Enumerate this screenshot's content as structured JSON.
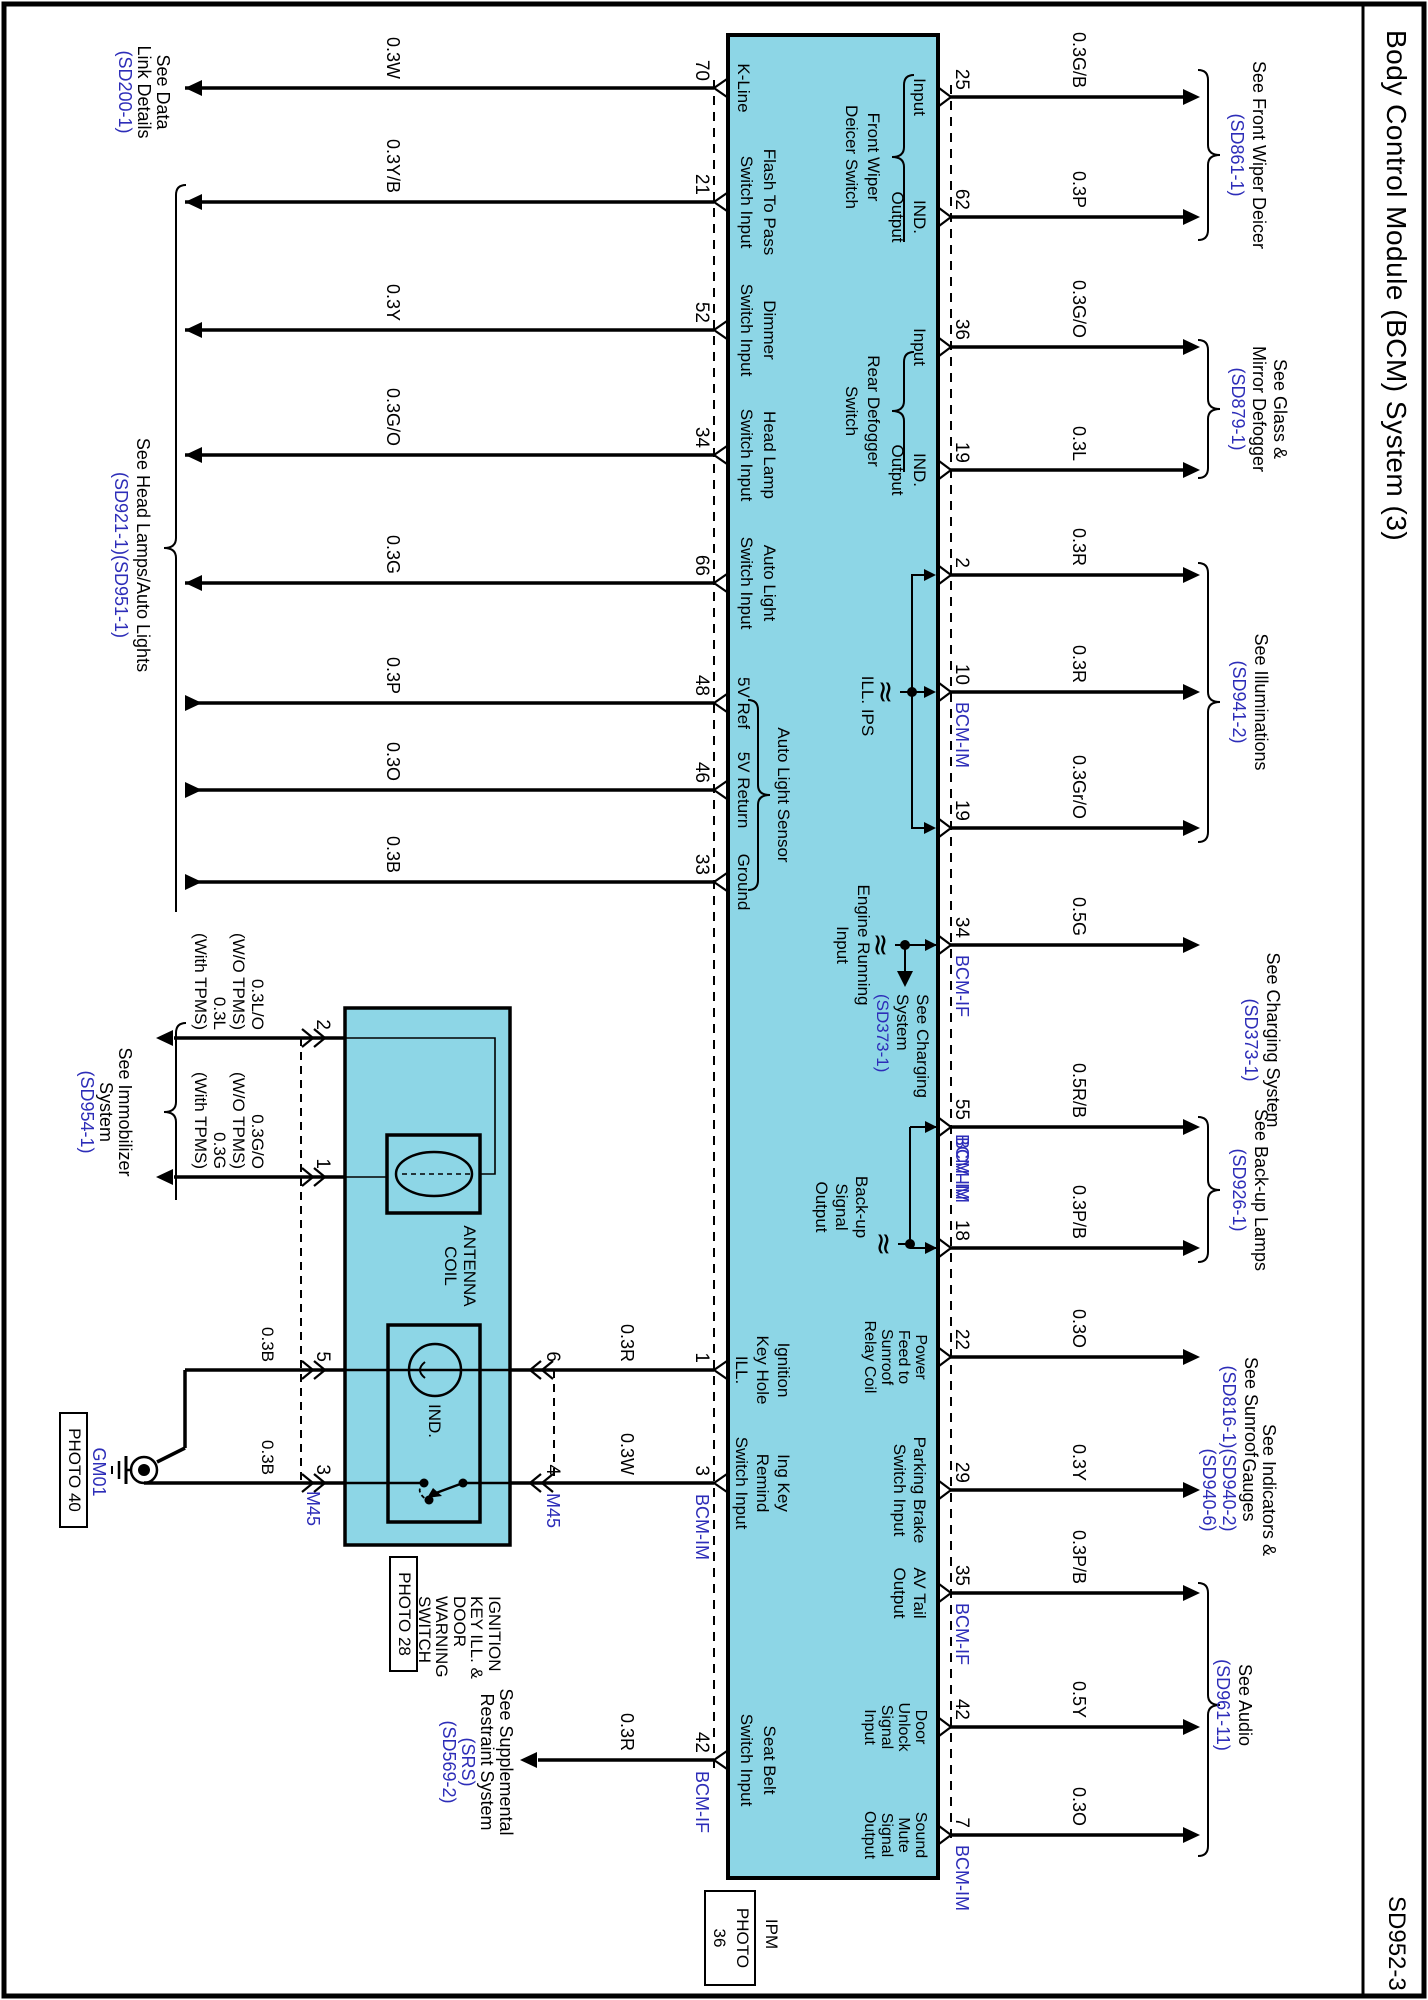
{
  "page": {
    "title": "Body Control Module (BCM) System (3)",
    "code": "SD952-3"
  },
  "colors": {
    "module_fill": "#8dd6e6",
    "reference_blue": "#2d2db8",
    "line": "#000000"
  },
  "top_pins": [
    {
      "num": "25",
      "x": 97,
      "wire": "0.3G/B",
      "inside": [
        "Input"
      ]
    },
    {
      "num": "62",
      "x": 217,
      "wire": "0.3P",
      "inside": [
        "IND.",
        "Output"
      ]
    },
    {
      "num": "36",
      "x": 347,
      "wire": "0.3G/O",
      "inside": [
        "Input"
      ]
    },
    {
      "num": "19",
      "x": 470,
      "wire": "0.3L",
      "inside": [
        "IND.",
        "Output"
      ]
    },
    {
      "num": "2",
      "x": 575,
      "wire": "0.3R",
      "inside": []
    },
    {
      "num": "10",
      "x": 692,
      "wire": "0.3R",
      "conn": "BCM-IM",
      "inside": []
    },
    {
      "num": "19",
      "x": 828,
      "wire": "0.3Gr/O",
      "inside": []
    },
    {
      "num": "34",
      "x": 945,
      "wire": "0.5G",
      "conn": "BCM-IF",
      "inside": []
    },
    {
      "num": "55",
      "x": 1127,
      "wire": "0.5R/B",
      "conn": "BCM-IM",
      "inside": []
    },
    {
      "num": "18",
      "x": 1248,
      "wire": "0.3P/B",
      "conn": "BCM-IM",
      "conn_pos": "before",
      "inside": []
    },
    {
      "num": "22",
      "x": 1357,
      "wire": "0.3O",
      "inside": [
        "Power",
        "Feed to",
        "Sunroof",
        "Relay Coil"
      ],
      "ilh": 17,
      "ifs": 16
    },
    {
      "num": "29",
      "x": 1490,
      "wire": "0.3Y",
      "inside": [
        "Parking Brake",
        "Switch Input"
      ],
      "ilh": 20
    },
    {
      "num": "35",
      "x": 1593,
      "wire": "0.3P/B",
      "conn": "BCM-IF",
      "inside": [
        "AV Tail",
        "Output"
      ],
      "ilh": 20
    },
    {
      "num": "42",
      "x": 1727,
      "wire": "0.5Y",
      "inside": [
        "Door",
        "Unlock",
        "Signal",
        "Input"
      ],
      "ilh": 17,
      "ifs": 16
    },
    {
      "num": "7",
      "x": 1835,
      "wire": "0.3O",
      "conn": "BCM-IM",
      "inside": [
        "Sound",
        "Mute",
        "Signal",
        "Output"
      ],
      "ilh": 17,
      "ifs": 16
    }
  ],
  "bottom_pins": [
    {
      "num": "70",
      "x": 88,
      "wire": "0.3W",
      "inside": [
        "K-Line"
      ],
      "dir": "out"
    },
    {
      "num": "21",
      "x": 202,
      "wire": "0.3Y/B",
      "inside": [
        "Flash To Pass",
        "Switch Input"
      ],
      "dir": "out"
    },
    {
      "num": "52",
      "x": 330,
      "wire": "0.3Y",
      "inside": [
        "Dimmer",
        "Switch Input"
      ],
      "dir": "out"
    },
    {
      "num": "34",
      "x": 455,
      "wire": "0.3G/O",
      "inside": [
        "Head Lamp",
        "Switch Input"
      ],
      "dir": "out"
    },
    {
      "num": "66",
      "x": 583,
      "wire": "0.3G",
      "inside": [
        "Auto Light",
        "Switch Input"
      ],
      "dir": "out"
    },
    {
      "num": "48",
      "x": 703,
      "wire": "0.3P",
      "inside": [
        "5V Ref"
      ],
      "dir": "in"
    },
    {
      "num": "46",
      "x": 790,
      "wire": "0.3O",
      "inside": [
        "5V Return"
      ],
      "dir": "in"
    },
    {
      "num": "33",
      "x": 882,
      "wire": "0.3B",
      "inside": [
        "Ground"
      ],
      "dir": "in"
    },
    {
      "num": "1",
      "x": 1370,
      "inside": [
        "Ignition",
        "Key Hole",
        "ILL."
      ],
      "short": true
    },
    {
      "num": "3",
      "x": 1483,
      "conn": "BCM-IM",
      "inside": [
        "Ing Key",
        "Remind",
        "Switch Input"
      ],
      "short": true
    },
    {
      "num": "42",
      "x": 1760,
      "wire": "0.3R",
      "conn": "BCM-IF",
      "inside": [
        "Seat Belt",
        "Switch Input"
      ],
      "dir": "out",
      "end": 890,
      "wy": 792
    }
  ],
  "internal_labels": [
    {
      "lines": [
        "Front Wiper",
        "Deicer Switch"
      ],
      "cx": 157,
      "y": 546,
      "lh": 22,
      "brace": [
        75,
        242,
        157
      ]
    },
    {
      "lines": [
        "Rear Defogger",
        "Switch"
      ],
      "cx": 411,
      "y": 546,
      "lh": 22,
      "brace": [
        352,
        472,
        411
      ]
    },
    {
      "lines": [
        "ILL. IPS"
      ],
      "cx": 706,
      "y": 552
    },
    {
      "lines": [
        "Engine Running",
        "Input"
      ],
      "cx": 945,
      "y": 556,
      "lh": 21
    },
    {
      "lines": [
        "Back-up",
        "Signal",
        "Output"
      ],
      "cx": 1207,
      "y": 558,
      "lh": 20
    },
    {
      "lines": [
        "Auto Light Sensor"
      ],
      "cx": 795,
      "y": 636,
      "sensor_brace": [
        700,
        890,
        795
      ]
    }
  ],
  "charging_note": {
    "lines": [
      "See Charging",
      "System",
      "(SD373-1)"
    ],
    "x": 994,
    "y": 497,
    "lh": 20
  },
  "refs_top": [
    {
      "lines": [
        "See Front Wiper Deicer",
        "(SD861-1)"
      ],
      "cx": 155,
      "y": 160,
      "lh": 22,
      "brace": [
        70,
        240,
        155
      ]
    },
    {
      "lines": [
        "See Glass &",
        "Mirror Defogger",
        "(SD879-1)"
      ],
      "cx": 409,
      "y": 139,
      "lh": 21,
      "brace": [
        340,
        478,
        409
      ]
    },
    {
      "lines": [
        "See Illuminations",
        "(SD941-2)"
      ],
      "cx": 702,
      "y": 158,
      "lh": 22,
      "brace": [
        563,
        842,
        702
      ]
    },
    {
      "lines": [
        "See Charging System",
        "(SD373-1)"
      ],
      "cx": 1040,
      "y": 146,
      "lh": 22
    },
    {
      "lines": [
        "See Back-up Lamps",
        "(SD926-1)"
      ],
      "cx": 1190,
      "y": 158,
      "lh": 22,
      "brace": [
        1117,
        1262,
        1190
      ]
    },
    {
      "lines": [
        "See Sunroof",
        "(SD816-1)"
      ],
      "cx": 1407,
      "y": 168,
      "lh": 22
    },
    {
      "lines": [
        "See Indicators &",
        "Gauges",
        "(SD940-2)",
        "(SD940-6)"
      ],
      "cx": 1490,
      "y": 150,
      "lh": 20
    },
    {
      "lines": [
        "See Audio",
        "(SD961-11)"
      ],
      "cx": 1705,
      "y": 174,
      "lh": 22,
      "brace": [
        1583,
        1856,
        1705
      ]
    }
  ],
  "refs_bottom": [
    {
      "lines": [
        "See Data",
        "Link Details",
        "(SD200-1)"
      ],
      "cx": 92,
      "y": 1256,
      "lh": 19
    },
    {
      "lines": [
        "See Head Lamps/Auto Lights",
        "(SD921-1)(SD951-1)"
      ],
      "cx": 555,
      "y": 1276,
      "lh": 22,
      "brace": [
        185,
        912,
        548
      ]
    },
    {
      "lines": [
        "See Immobilizer",
        "System",
        "(SD954-1)"
      ],
      "cx": 1112,
      "y": 1294,
      "lh": 19,
      "brace": [
        1023,
        1200,
        1112
      ]
    },
    {
      "lines": [
        "See Supplemental",
        "Restraint System",
        "(SRS)",
        "(SD569-2)"
      ],
      "cx": 1762,
      "y": 913,
      "lh": 19
    }
  ],
  "immobilizer": {
    "antenna_label": [
      "ANTENNA",
      "COIL"
    ],
    "ind_label": "IND.",
    "switch_label": [
      "IGNITION",
      "KEY ILL. &",
      "DOOR",
      "WARNING",
      "SWITCH"
    ],
    "photo28": "PHOTO 28",
    "photo40": "PHOTO 40",
    "gm01": "GM01",
    "m45_lower": "M45",
    "m45_upper": "M45",
    "rows": [
      {
        "num": "2",
        "x": 1038,
        "labels": [
          "0.3L/O",
          "(W/O TPMS)",
          "0.3L",
          "(With TPMS)"
        ]
      },
      {
        "num": "1",
        "x": 1177,
        "labels": [
          "0.3G/O",
          "(W/O TPMS)",
          "0.3G",
          "(With TPMS)"
        ]
      },
      {
        "num": "5",
        "x": 1370,
        "labels": [
          "0.3B"
        ]
      },
      {
        "num": "3",
        "x": 1483,
        "labels": [
          "0.3B"
        ]
      },
      {
        "num": "6",
        "x": 1370,
        "labels": [
          "0.3R"
        ]
      },
      {
        "num": "4",
        "x": 1483,
        "labels": [
          "0.3W"
        ]
      }
    ]
  },
  "ipm": {
    "name": "IPM",
    "photo_lines": [
      "PHOTO",
      "36"
    ]
  }
}
